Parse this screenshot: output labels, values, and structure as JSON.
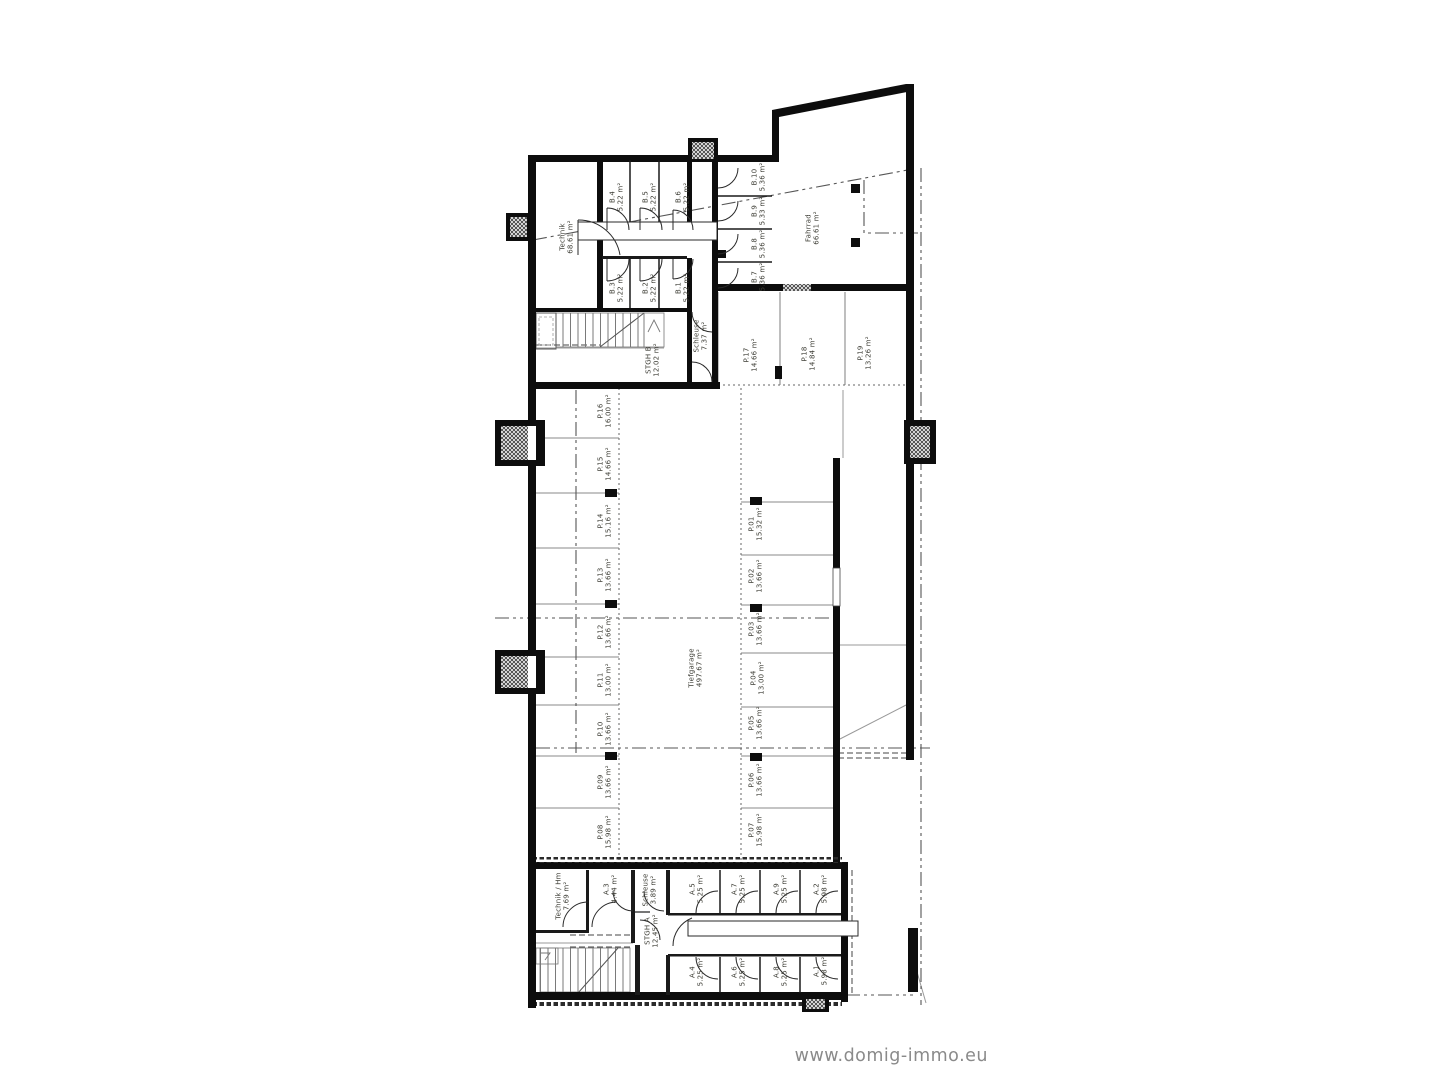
{
  "watermark": {
    "text": "www.domig-immo.eu",
    "color": "#8a8a8a"
  },
  "plan": {
    "type": "floorplan",
    "label_color": "#3c3c34",
    "wall_color": "#0d0d0d",
    "rooms": [
      {
        "id": "technik-b",
        "label": "Technik",
        "area": "68.61 m²",
        "x": 566,
        "y": 237
      },
      {
        "id": "b4",
        "label": "B.4",
        "area": "5.22 m²",
        "x": 616,
        "y": 197
      },
      {
        "id": "b5",
        "label": "B.5",
        "area": "5.22 m²",
        "x": 649,
        "y": 197
      },
      {
        "id": "b6",
        "label": "B.6",
        "area": "5.22 m²",
        "x": 682,
        "y": 197
      },
      {
        "id": "b3",
        "label": "B.3",
        "area": "5.22 m²",
        "x": 616,
        "y": 288
      },
      {
        "id": "b2",
        "label": "B.2",
        "area": "5.22 m²",
        "x": 649,
        "y": 288
      },
      {
        "id": "b1",
        "label": "B.1",
        "area": "5.22 m²",
        "x": 682,
        "y": 288
      },
      {
        "id": "b10",
        "label": "B.10",
        "area": "5.36 m²",
        "x": 758,
        "y": 177
      },
      {
        "id": "b9",
        "label": "B.9",
        "area": "5.33 m²",
        "x": 758,
        "y": 211
      },
      {
        "id": "b8",
        "label": "B.8",
        "area": "5.36 m²",
        "x": 758,
        "y": 244
      },
      {
        "id": "b7",
        "label": "B.7",
        "area": "5.36 m²",
        "x": 758,
        "y": 277
      },
      {
        "id": "fahrrad",
        "label": "Fahrrad",
        "area": "66.61 m²",
        "x": 812,
        "y": 228
      },
      {
        "id": "schleuse-b",
        "label": "Schleuse",
        "area": "7.37 m²",
        "x": 700,
        "y": 336
      },
      {
        "id": "stgh-b",
        "label": "STGH B",
        "area": "12.02 m²",
        "x": 652,
        "y": 360
      },
      {
        "id": "p17",
        "label": "P.17",
        "area": "14.66 m²",
        "x": 750,
        "y": 355
      },
      {
        "id": "p18",
        "label": "P.18",
        "area": "14.84 m²",
        "x": 808,
        "y": 354
      },
      {
        "id": "p19",
        "label": "P.19",
        "area": "13.26 m²",
        "x": 864,
        "y": 353
      },
      {
        "id": "p16",
        "label": "P.16",
        "area": "16.00 m²",
        "x": 604,
        "y": 411
      },
      {
        "id": "p15",
        "label": "P.15",
        "area": "14.66 m²",
        "x": 604,
        "y": 464
      },
      {
        "id": "p14",
        "label": "P.14",
        "area": "15.16 m²",
        "x": 604,
        "y": 521
      },
      {
        "id": "p13",
        "label": "P.13",
        "area": "13.66 m²",
        "x": 604,
        "y": 575
      },
      {
        "id": "p12",
        "label": "P.12",
        "area": "13.66 m²",
        "x": 604,
        "y": 632
      },
      {
        "id": "p11",
        "label": "P.11",
        "area": "13.00 m²",
        "x": 604,
        "y": 680
      },
      {
        "id": "p10",
        "label": "P.10",
        "area": "13.66 m²",
        "x": 604,
        "y": 729
      },
      {
        "id": "p09",
        "label": "P.09",
        "area": "13.66 m²",
        "x": 604,
        "y": 782
      },
      {
        "id": "p08",
        "label": "P.08",
        "area": "15.98 m²",
        "x": 604,
        "y": 832
      },
      {
        "id": "p01",
        "label": "P.01",
        "area": "15.32 m²",
        "x": 755,
        "y": 524
      },
      {
        "id": "p02",
        "label": "P.02",
        "area": "13.66 m²",
        "x": 755,
        "y": 576
      },
      {
        "id": "p03",
        "label": "P.03",
        "area": "13.66 m²",
        "x": 755,
        "y": 629
      },
      {
        "id": "p04",
        "label": "P.04",
        "area": "13.00 m²",
        "x": 757,
        "y": 678
      },
      {
        "id": "p05",
        "label": "P.05",
        "area": "13.66 m²",
        "x": 755,
        "y": 723
      },
      {
        "id": "p06",
        "label": "P.06",
        "area": "13.66 m²",
        "x": 755,
        "y": 780
      },
      {
        "id": "p07",
        "label": "P.07",
        "area": "15.98 m²",
        "x": 755,
        "y": 830
      },
      {
        "id": "tiefgarage",
        "label": "Tiefgarage",
        "area": "497.67 m²",
        "x": 695,
        "y": 668
      },
      {
        "id": "technik-a",
        "label": "Technik / Hm",
        "area": "7.69 m²",
        "x": 562,
        "y": 896
      },
      {
        "id": "a3",
        "label": "A.3",
        "area": "4.44 m²",
        "x": 610,
        "y": 889
      },
      {
        "id": "schleuse-a",
        "label": "Schleuse",
        "area": "3.89 m²",
        "x": 649,
        "y": 890
      },
      {
        "id": "stgh-a",
        "label": "STGH A",
        "area": "12.45 m²",
        "x": 651,
        "y": 931
      },
      {
        "id": "a5",
        "label": "A.5",
        "area": "5.25 m²",
        "x": 696,
        "y": 889
      },
      {
        "id": "a7",
        "label": "A.7",
        "area": "5.25 m²",
        "x": 738,
        "y": 889
      },
      {
        "id": "a9",
        "label": "A.9",
        "area": "5.25 m²",
        "x": 780,
        "y": 889
      },
      {
        "id": "a2",
        "label": "A.2",
        "area": "5.98 m²",
        "x": 820,
        "y": 889
      },
      {
        "id": "a4",
        "label": "A.4",
        "area": "5.25 m²",
        "x": 696,
        "y": 972
      },
      {
        "id": "a6",
        "label": "A.6",
        "area": "5.25 m²",
        "x": 738,
        "y": 972
      },
      {
        "id": "a8",
        "label": "A.8",
        "area": "5.25 m²",
        "x": 780,
        "y": 972
      },
      {
        "id": "a1",
        "label": "A.1",
        "area": "5.98 m²",
        "x": 820,
        "y": 971
      }
    ]
  }
}
